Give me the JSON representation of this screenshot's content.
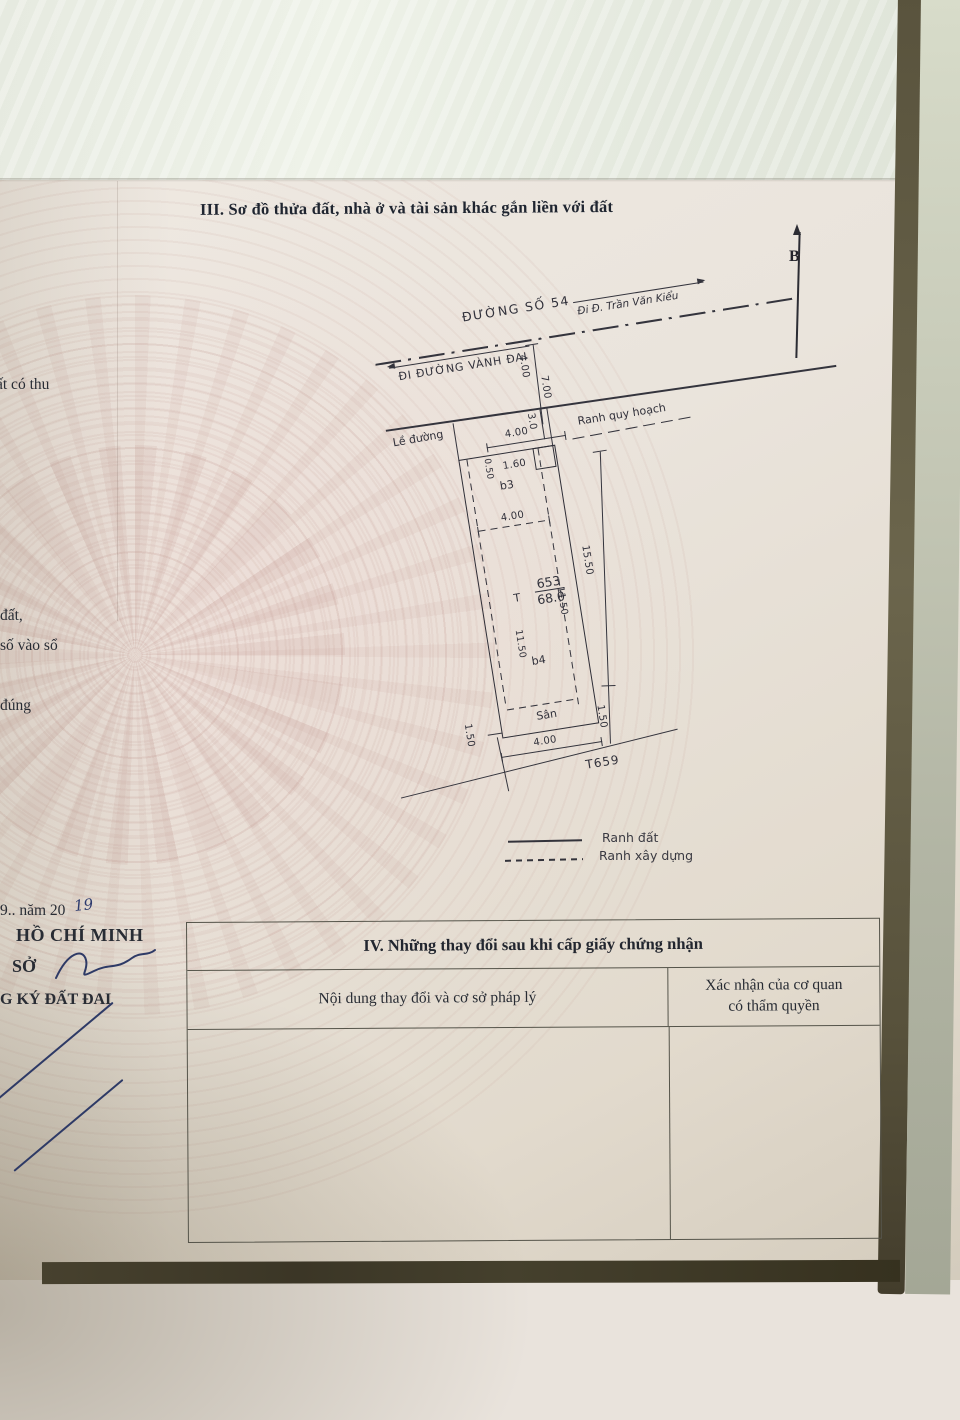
{
  "page": {
    "section3_title": "III. Sơ đồ thửa đất, nhà ở và tài sản khác gắn liền với đất",
    "north_label": "B"
  },
  "diagram": {
    "road_name": "ĐƯỜNG SỐ 54",
    "dir_left": "ĐI ĐƯỜNG VÀNH ĐAI",
    "dir_right": "Đi Đ. Trần Văn Kiểu",
    "curb_label": "Lề đường",
    "planning_label": "Ranh quy hoạch",
    "dims": {
      "road_width": "4.00",
      "road_width2": "7.00",
      "setback": "3.0",
      "curb_width": "4.00",
      "top_left": "0.50",
      "top_right": "1.60",
      "inner_width": "4.00",
      "t_mark": "T",
      "parcel_number": "653",
      "area": "68.0",
      "side_left": "11.50",
      "side_right": "11.50",
      "depth_right": "15.50",
      "yard_left": "1.50",
      "yard_right": "1.50",
      "bottom_width": "4.00",
      "adjacent_parcel": "T659"
    },
    "zones": {
      "b3": "b3",
      "b4": "b4",
      "yard": "Sân"
    },
    "legend": [
      {
        "style": "solid",
        "label": "Ranh đất"
      },
      {
        "style": "dashed",
        "label": "Ranh xây dựng"
      }
    ]
  },
  "table4": {
    "title": "IV. Những thay đổi sau khi cấp giấy chứng nhận",
    "col1": "Nội dung thay đổi và cơ sở pháp lý",
    "col2_line1": "Xác nhận của cơ quan",
    "col2_line2": "có thẩm quyền"
  },
  "left_fragments": {
    "f1": "ất có thu",
    "f2": "đất,",
    "f3": "số vào sổ",
    "f4": "đúng",
    "f5": "9..  năm 20",
    "f5_hand": "19",
    "f6": "HỒ CHÍ MINH",
    "f7": "SỞ",
    "f8": "G KÝ ĐẤT ĐAI"
  },
  "colors": {
    "ink": "#262a33",
    "pen_blue": "#2e3a66",
    "paper": "#e9e3dc"
  }
}
